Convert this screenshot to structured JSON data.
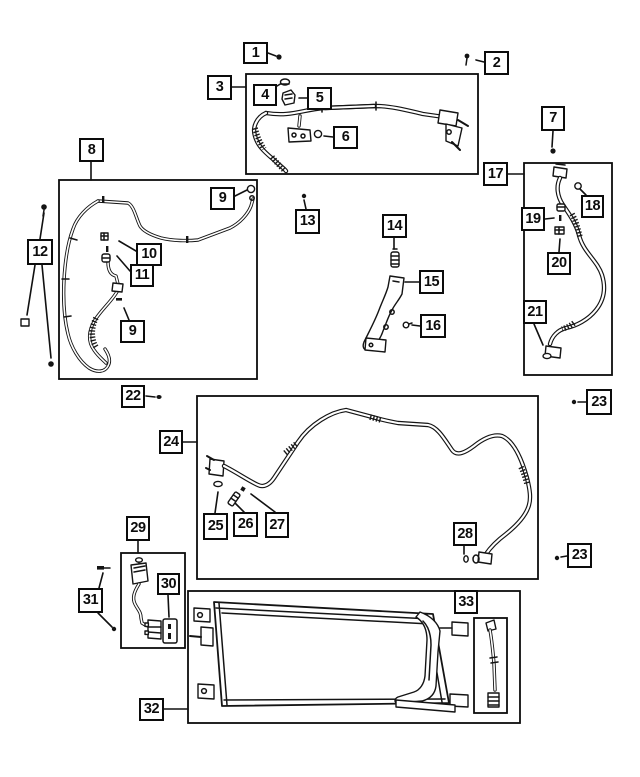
{
  "diagram": {
    "kind": "exploded-parts-diagram",
    "subject": "A/C lines, hoses and condenser",
    "colors": {
      "background": "#ffffff",
      "line": "#141414",
      "callout_border": "#0c0c0c",
      "callout_text": "#0c0c0c"
    },
    "callouts": [
      {
        "id": "c1",
        "label": "1",
        "x": 243,
        "y": 42,
        "w": 25,
        "h": 22
      },
      {
        "id": "c2",
        "label": "2",
        "x": 484,
        "y": 51,
        "w": 25,
        "h": 24
      },
      {
        "id": "c3",
        "label": "3",
        "x": 207,
        "y": 75,
        "w": 25,
        "h": 25
      },
      {
        "id": "c4",
        "label": "4",
        "x": 253,
        "y": 84,
        "w": 24,
        "h": 22
      },
      {
        "id": "c5",
        "label": "5",
        "x": 307,
        "y": 87,
        "w": 25,
        "h": 23
      },
      {
        "id": "c6",
        "label": "6",
        "x": 333,
        "y": 126,
        "w": 25,
        "h": 23
      },
      {
        "id": "c7",
        "label": "7",
        "x": 541,
        "y": 106,
        "w": 24,
        "h": 25
      },
      {
        "id": "c8",
        "label": "8",
        "x": 79,
        "y": 138,
        "w": 25,
        "h": 24
      },
      {
        "id": "c9a",
        "label": "9",
        "x": 210,
        "y": 187,
        "w": 25,
        "h": 23
      },
      {
        "id": "c10",
        "label": "10",
        "x": 136,
        "y": 243,
        "w": 26,
        "h": 23
      },
      {
        "id": "c11",
        "label": "11",
        "x": 130,
        "y": 264,
        "w": 24,
        "h": 23
      },
      {
        "id": "c9b",
        "label": "9",
        "x": 120,
        "y": 320,
        "w": 25,
        "h": 23
      },
      {
        "id": "c12",
        "label": "12",
        "x": 27,
        "y": 239,
        "w": 26,
        "h": 26
      },
      {
        "id": "c13",
        "label": "13",
        "x": 295,
        "y": 209,
        "w": 25,
        "h": 25
      },
      {
        "id": "c14",
        "label": "14",
        "x": 382,
        "y": 214,
        "w": 25,
        "h": 24
      },
      {
        "id": "c15",
        "label": "15",
        "x": 419,
        "y": 270,
        "w": 25,
        "h": 24
      },
      {
        "id": "c16",
        "label": "16",
        "x": 420,
        "y": 314,
        "w": 26,
        "h": 24
      },
      {
        "id": "c17",
        "label": "17",
        "x": 483,
        "y": 162,
        "w": 25,
        "h": 24
      },
      {
        "id": "c18",
        "label": "18",
        "x": 581,
        "y": 195,
        "w": 23,
        "h": 23
      },
      {
        "id": "c19",
        "label": "19",
        "x": 521,
        "y": 207,
        "w": 24,
        "h": 24
      },
      {
        "id": "c20",
        "label": "20",
        "x": 547,
        "y": 252,
        "w": 24,
        "h": 23
      },
      {
        "id": "c21",
        "label": "21",
        "x": 523,
        "y": 300,
        "w": 24,
        "h": 24
      },
      {
        "id": "c22",
        "label": "22",
        "x": 121,
        "y": 385,
        "w": 24,
        "h": 23
      },
      {
        "id": "c23a",
        "label": "23",
        "x": 586,
        "y": 389,
        "w": 26,
        "h": 26
      },
      {
        "id": "c24",
        "label": "24",
        "x": 159,
        "y": 430,
        "w": 24,
        "h": 24
      },
      {
        "id": "c25",
        "label": "25",
        "x": 203,
        "y": 513,
        "w": 25,
        "h": 27
      },
      {
        "id": "c26",
        "label": "26",
        "x": 233,
        "y": 512,
        "w": 25,
        "h": 25
      },
      {
        "id": "c27",
        "label": "27",
        "x": 265,
        "y": 512,
        "w": 24,
        "h": 26
      },
      {
        "id": "c28",
        "label": "28",
        "x": 453,
        "y": 522,
        "w": 24,
        "h": 24
      },
      {
        "id": "c23b",
        "label": "23",
        "x": 567,
        "y": 543,
        "w": 25,
        "h": 25
      },
      {
        "id": "c29",
        "label": "29",
        "x": 126,
        "y": 516,
        "w": 24,
        "h": 25
      },
      {
        "id": "c30",
        "label": "30",
        "x": 157,
        "y": 573,
        "w": 23,
        "h": 22
      },
      {
        "id": "c31",
        "label": "31",
        "x": 78,
        "y": 588,
        "w": 25,
        "h": 25
      },
      {
        "id": "c32",
        "label": "32",
        "x": 139,
        "y": 698,
        "w": 25,
        "h": 23
      },
      {
        "id": "c33",
        "label": "33",
        "x": 454,
        "y": 590,
        "w": 24,
        "h": 24
      }
    ]
  }
}
